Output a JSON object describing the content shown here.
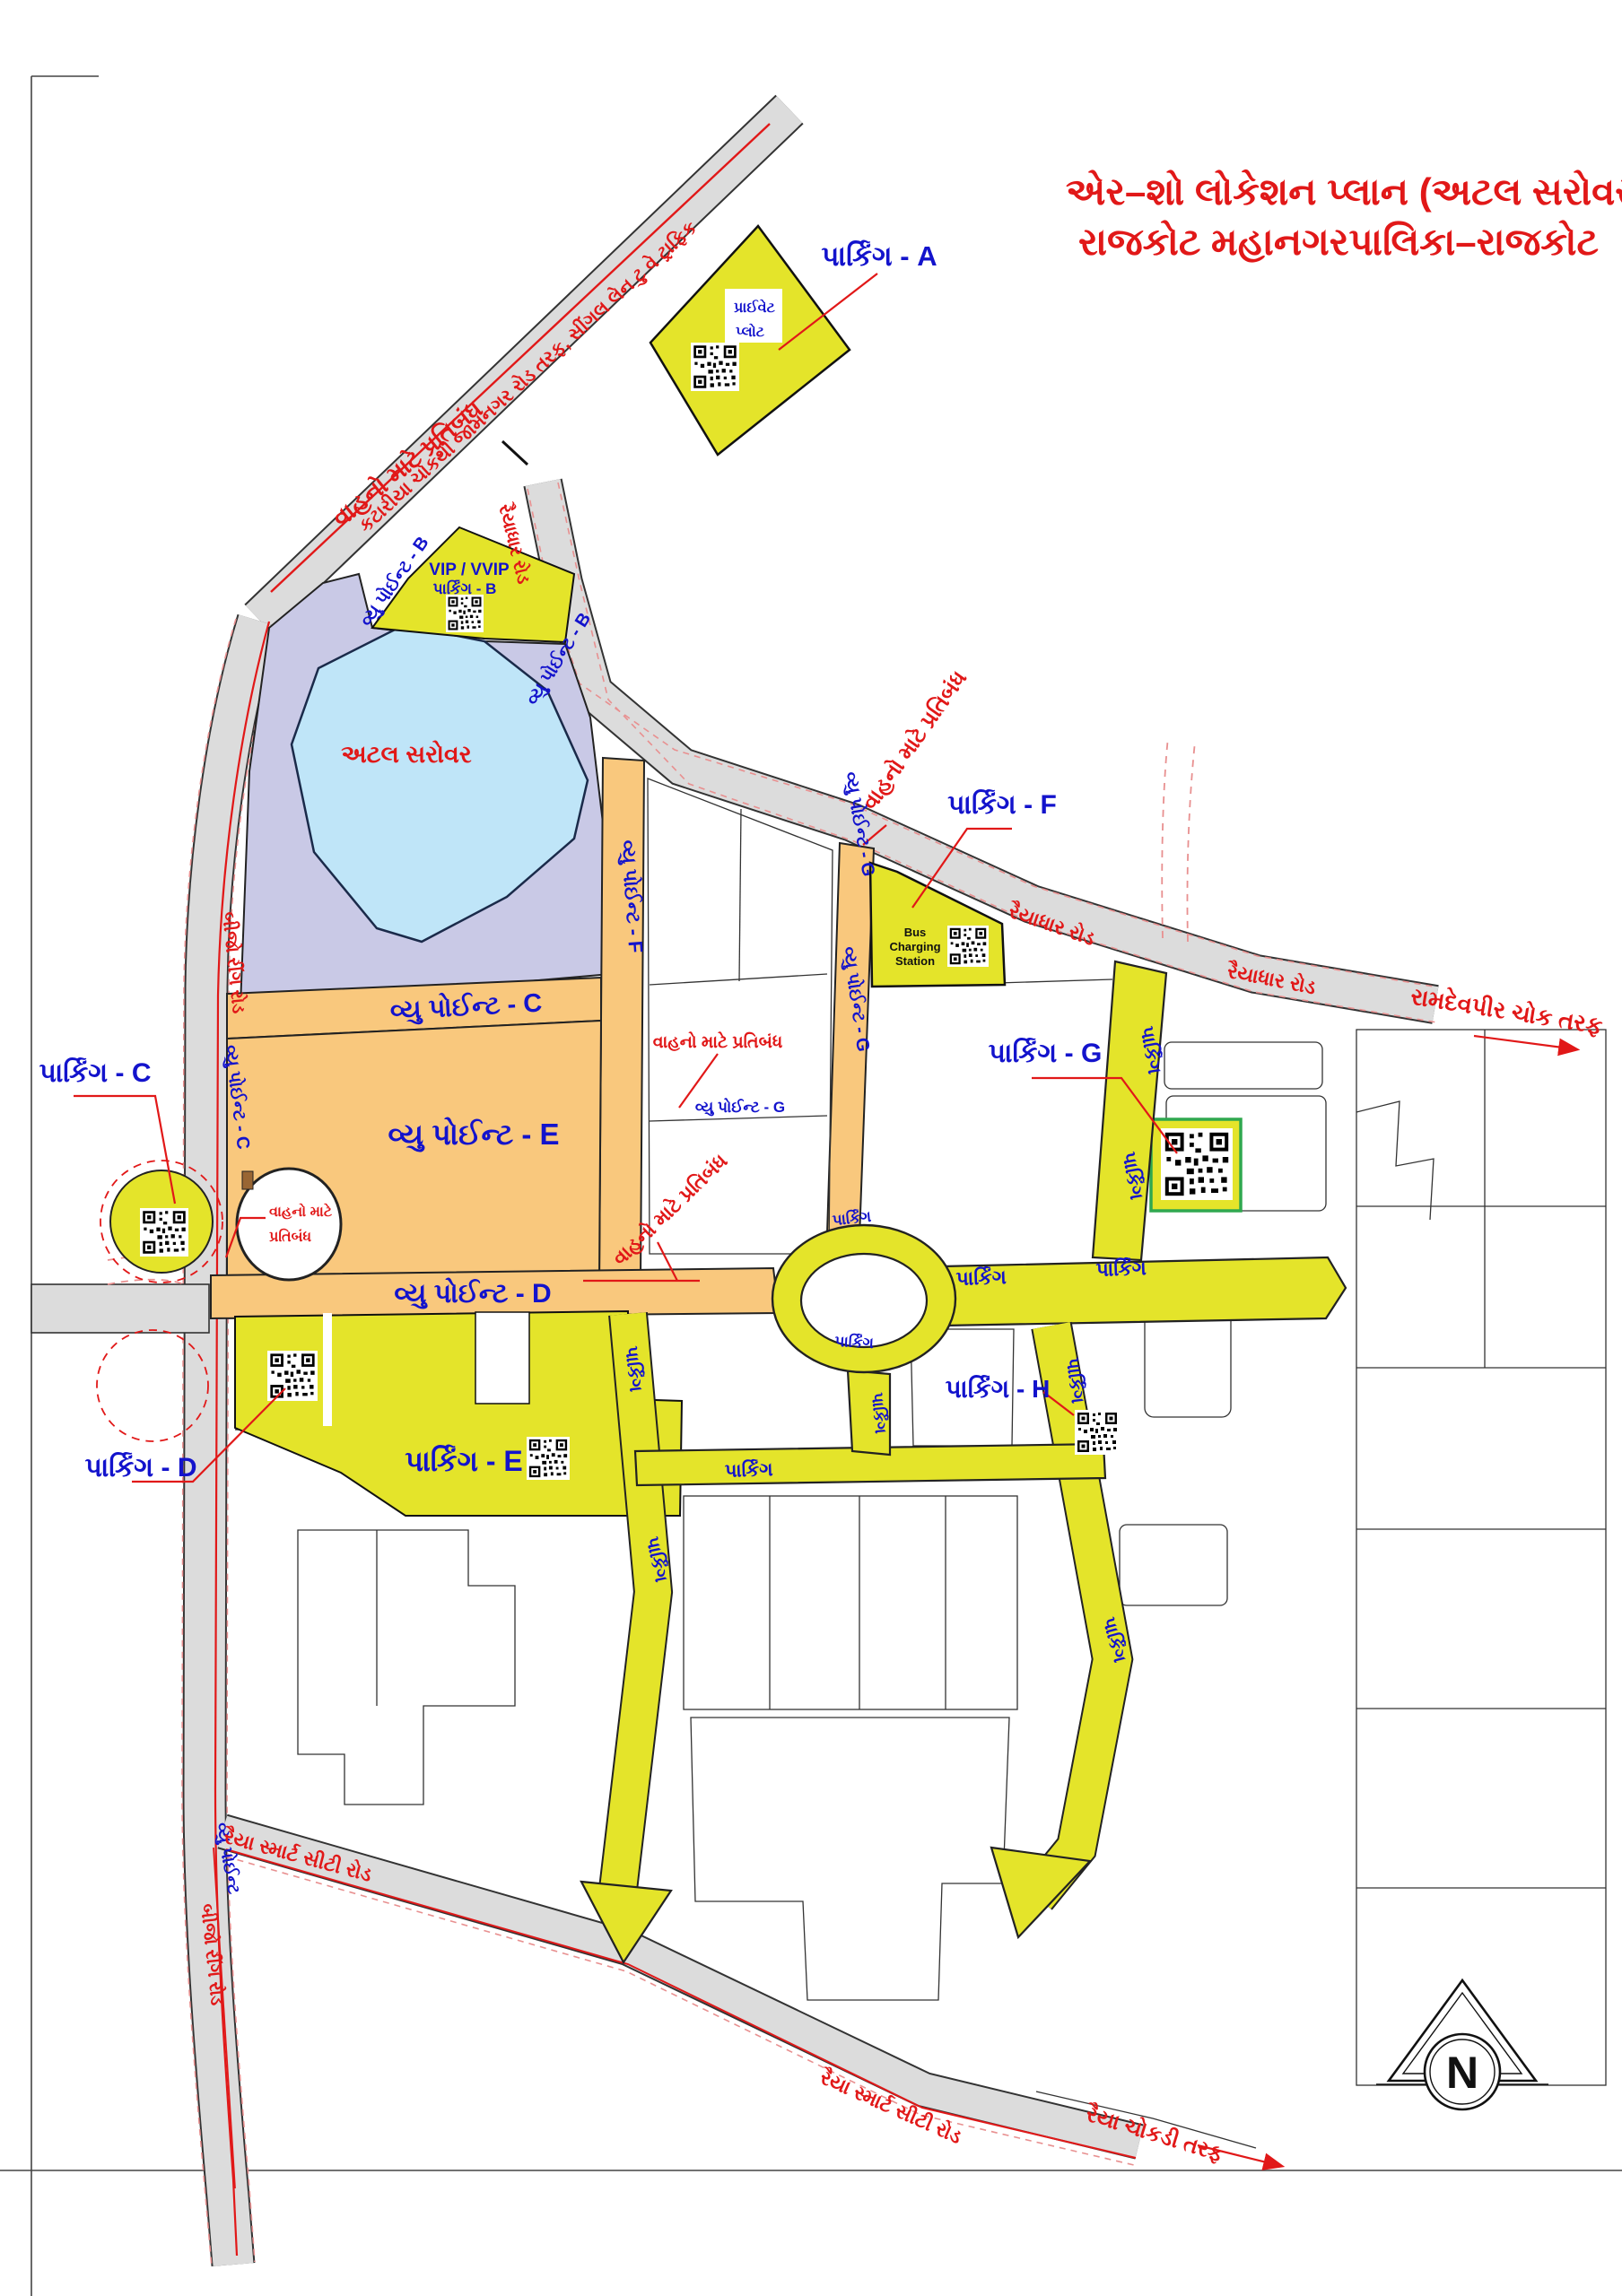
{
  "title": {
    "line1": "એર–શો લોકેશન પ્લાન (અટલ સરોવર)",
    "line2": "રાજકોટ મહાનગરપાલિકા–રાજકોટ"
  },
  "parking_labels": {
    "a": "પાર્કિંગ - A",
    "b_line1": "VIP / VVIP",
    "b_line2": "પાર્કિંગ - B",
    "c": "પાર્કિંગ - C",
    "d": "પાર્કિંગ - D",
    "e": "પાર્કિંગ - E",
    "f": "પાર્કિંગ - F",
    "g": "પાર્કિંગ - G",
    "h": "પાર્કિંગ - H",
    "generic": "પાર્કિંગ"
  },
  "viewpoints": {
    "b": "વ્યુ પોઈન્ટ - B",
    "c": "વ્યુ પોઈન્ટ - C",
    "d": "વ્યુ પોઈન્ટ - D",
    "e": "વ્યુ પોઈન્ટ - E",
    "f": "વ્યુ પોઈન્ટ - F",
    "g": "વ્યુ પોઈન્ટ - G",
    "generic": "વ્યુ પોઈન્ટ"
  },
  "roads": {
    "katariya": "કટારીયા ચોકથી જામનગર રોડ તરફ, સીંગલ લેન ટુ વે ટ્રાફિક",
    "raiyadhar": "રૈયાધાર રોડ",
    "bijo_ring": "બીજો રીંગ રોડ",
    "raiya_smart_city": "રૈયા સ્માર્ટ સીટી રોડ",
    "ramdevpir": "રામદેવપીર ચોક તરફ",
    "raiya_chokdi": "રૈયા ચોકડી તરફ"
  },
  "notes": {
    "restriction": "વાહનો માટે પ્રતિબંધ",
    "restriction_line1": "વાહનો માટે",
    "restriction_line2": "પ્રતિબંધ",
    "private_plot_line1": "પ્રાઈવેટ",
    "private_plot_line2": "પ્લોટ",
    "lake": "અટલ સરોવર",
    "bus_line1": "Bus",
    "bus_line2": "Charging",
    "bus_line3": "Station",
    "north": "N"
  },
  "colors": {
    "parking_yellow": "#e4e42a",
    "road_orange": "#f9c87d",
    "road_grey": "#dcdcdc",
    "lake_blue": "#bfe5f8",
    "lavender": "#c9c9e6",
    "label_blue": "#1313cc",
    "label_red": "#e11818",
    "green_border": "#2fa84f"
  }
}
